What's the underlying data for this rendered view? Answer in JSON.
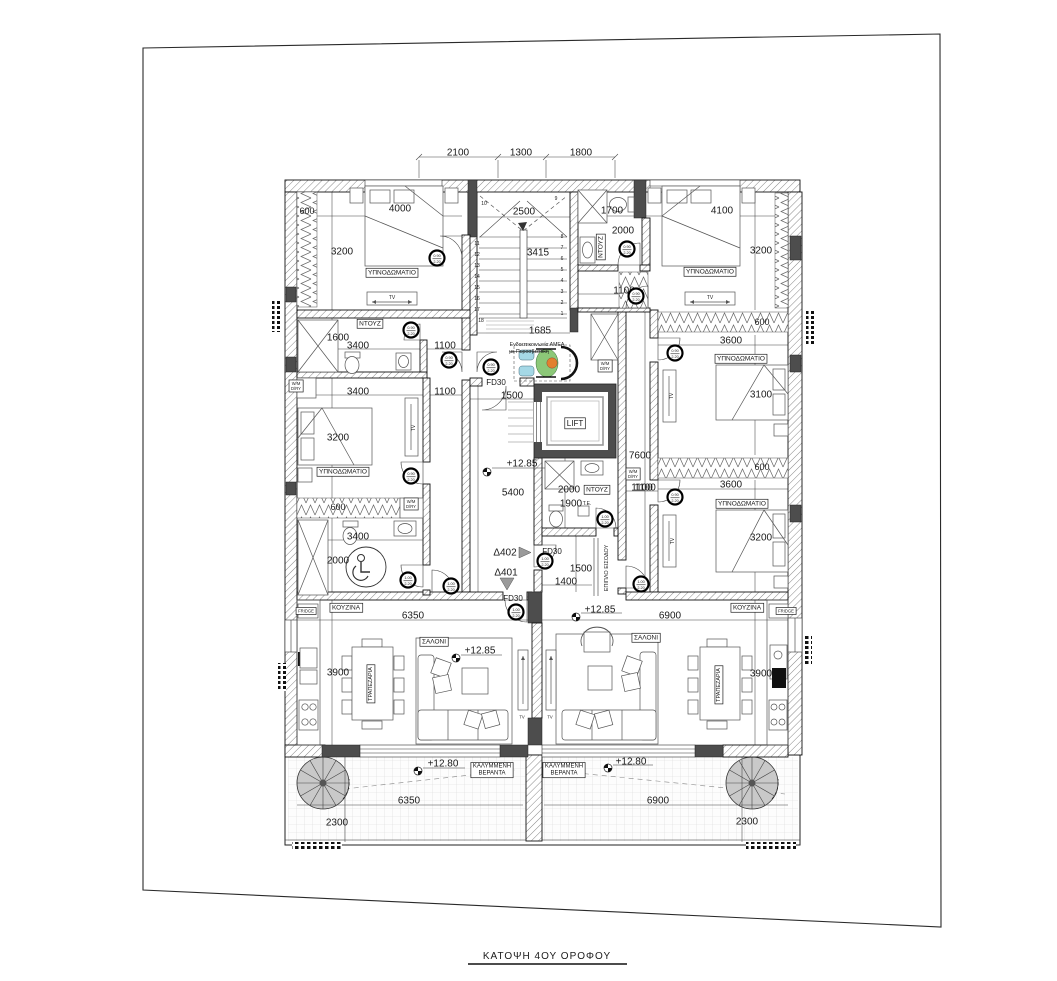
{
  "title": {
    "text": "ΚΑΤΟΨΗ 4ΟΥ ΟΡΟΦΟΥ"
  },
  "colors": {
    "wall_dark": "#4d4d4d",
    "wheelchair_blue": "#a5d8e6",
    "wheelchair_green": "#8cc878",
    "wheelchair_orange": "#e2802f",
    "spiral_gray": "#c9c9c9"
  },
  "plan": {
    "labels": [
      {
        "n": "dim-top-2100",
        "t": "2100",
        "x": 458,
        "y": 152,
        "s": 10
      },
      {
        "n": "dim-top-1300",
        "t": "1300",
        "x": 521,
        "y": 152,
        "s": 10
      },
      {
        "n": "dim-top-1800",
        "t": "1800",
        "x": 581,
        "y": 152,
        "s": 10
      },
      {
        "n": "dim-600-tl",
        "t": "600",
        "x": 307,
        "y": 211,
        "s": 9
      },
      {
        "n": "dim-4000",
        "t": "4000",
        "x": 400,
        "y": 208,
        "s": 10
      },
      {
        "n": "dim-3200-tl",
        "t": "3200",
        "x": 342,
        "y": 251,
        "s": 10
      },
      {
        "n": "room-bedroom-tl",
        "t": "ΥΠΝΟΔΩΜΑΤΙΟ",
        "x": 392,
        "y": 272,
        "s": 6.5,
        "b": 1
      },
      {
        "n": "tv-label-tl",
        "t": "TV",
        "x": 392,
        "y": 297,
        "s": 5
      },
      {
        "n": "dim-2500",
        "t": "2500",
        "x": 524,
        "y": 211,
        "s": 10
      },
      {
        "n": "dim-3415",
        "t": "3415",
        "x": 538,
        "y": 252,
        "s": 10
      },
      {
        "n": "dim-1685",
        "t": "1685",
        "x": 540,
        "y": 330,
        "s": 10
      },
      {
        "n": "step-8",
        "t": "8",
        "x": 562,
        "y": 236,
        "s": 5
      },
      {
        "n": "step-7",
        "t": "7",
        "x": 562,
        "y": 247,
        "s": 5
      },
      {
        "n": "step-6",
        "t": "6",
        "x": 562,
        "y": 258,
        "s": 5
      },
      {
        "n": "step-5",
        "t": "5",
        "x": 562,
        "y": 269,
        "s": 5
      },
      {
        "n": "step-4",
        "t": "4",
        "x": 562,
        "y": 280,
        "s": 5
      },
      {
        "n": "step-3",
        "t": "3",
        "x": 562,
        "y": 291,
        "s": 5
      },
      {
        "n": "step-2",
        "t": "2",
        "x": 562,
        "y": 302,
        "s": 5
      },
      {
        "n": "step-1",
        "t": "1",
        "x": 562,
        "y": 313,
        "s": 5
      },
      {
        "n": "step-11",
        "t": "11",
        "x": 477,
        "y": 243,
        "s": 5
      },
      {
        "n": "step-12",
        "t": "12",
        "x": 477,
        "y": 254,
        "s": 5
      },
      {
        "n": "step-13",
        "t": "13",
        "x": 477,
        "y": 265,
        "s": 5
      },
      {
        "n": "step-14",
        "t": "14",
        "x": 477,
        "y": 276,
        "s": 5
      },
      {
        "n": "step-15",
        "t": "15",
        "x": 477,
        "y": 287,
        "s": 5
      },
      {
        "n": "step-16",
        "t": "16",
        "x": 477,
        "y": 298,
        "s": 5
      },
      {
        "n": "step-17",
        "t": "17",
        "x": 477,
        "y": 309,
        "s": 5
      },
      {
        "n": "step-18",
        "t": "18",
        "x": 481,
        "y": 320,
        "s": 5
      },
      {
        "n": "step-9",
        "t": "9",
        "x": 556,
        "y": 198,
        "s": 5
      },
      {
        "n": "step-10",
        "t": "10",
        "x": 484,
        "y": 203,
        "s": 5
      },
      {
        "n": "amea-note",
        "t": "Ενδοεπικοινωνία ΑΜΕΑ",
        "x": 537,
        "y": 344,
        "s": 5.2
      },
      {
        "n": "amea-note-2",
        "t": "με Πυροσβεστική",
        "x": 529,
        "y": 351,
        "s": 5.2,
        "k": 1
      },
      {
        "n": "dim-1700",
        "t": "1700",
        "x": 612,
        "y": 210,
        "s": 10
      },
      {
        "n": "dim-2000-tr",
        "t": "2000",
        "x": 623,
        "y": 230,
        "s": 10
      },
      {
        "n": "room-ntouz-tr",
        "t": "ΝΤΟΥΖ",
        "x": 600,
        "y": 247,
        "s": 6.5,
        "r": -90,
        "b": 1
      },
      {
        "n": "dim-4100",
        "t": "4100",
        "x": 722,
        "y": 210,
        "s": 10
      },
      {
        "n": "dim-3200-tr",
        "t": "3200",
        "x": 761,
        "y": 250,
        "s": 10
      },
      {
        "n": "room-bedroom-tr",
        "t": "ΥΠΝΟΔΩΜΑΤΙΟ",
        "x": 710,
        "y": 271,
        "s": 6.5,
        "b": 1
      },
      {
        "n": "tv-label-tr",
        "t": "TV",
        "x": 710,
        "y": 297,
        "s": 5
      },
      {
        "n": "dim-1100-tr",
        "t": "1100",
        "x": 624,
        "y": 290,
        "s": 10
      },
      {
        "n": "wm-1",
        "L": [
          "W/M",
          "D/RY"
        ],
        "x": 605,
        "y": 366,
        "s": 4.2,
        "b": 1
      },
      {
        "n": "wm-2",
        "L": [
          "W/M",
          "D/RY"
        ],
        "x": 633,
        "y": 474,
        "s": 4.2,
        "b": 1
      },
      {
        "n": "wm-3",
        "L": [
          "W/M",
          "D/RY"
        ],
        "x": 411,
        "y": 504,
        "s": 4.2,
        "b": 1
      },
      {
        "n": "wm-4",
        "L": [
          "W/M",
          "D/RY"
        ],
        "x": 296,
        "y": 386,
        "s": 4.2,
        "b": 1
      },
      {
        "n": "dim-600-rm",
        "t": "600",
        "x": 762,
        "y": 322,
        "s": 9
      },
      {
        "n": "dim-3600-rm",
        "t": "3600",
        "x": 731,
        "y": 340,
        "s": 10
      },
      {
        "n": "room-bedroom-rm",
        "t": "ΥΠΝΟΔΩΜΑΤΙΟ",
        "x": 741,
        "y": 358,
        "s": 6.5,
        "b": 1
      },
      {
        "n": "dim-3100",
        "t": "3100",
        "x": 761,
        "y": 394,
        "s": 10
      },
      {
        "n": "tv-label-rm",
        "t": "TV",
        "x": 671,
        "y": 396,
        "s": 5,
        "r": -90
      },
      {
        "n": "dim-7600",
        "t": "7600",
        "x": 640,
        "y": 455,
        "s": 10
      },
      {
        "n": "dim-600-rm2",
        "t": "600",
        "x": 762,
        "y": 467,
        "s": 9
      },
      {
        "n": "dim-1100-rl",
        "t": "1100",
        "x": 642,
        "y": 487,
        "s": 10
      },
      {
        "n": "dim-3600-rl",
        "t": "3600",
        "x": 731,
        "y": 484,
        "s": 10
      },
      {
        "n": "room-bedroom-rl",
        "t": "ΥΠΝΟΔΩΜΑΤΙΟ",
        "x": 742,
        "y": 503,
        "s": 6.5,
        "b": 1
      },
      {
        "n": "dim-3200-rl",
        "t": "3200",
        "x": 761,
        "y": 537,
        "s": 10
      },
      {
        "n": "tv-label-rl",
        "t": "TV",
        "x": 672,
        "y": 541,
        "s": 5,
        "r": -90
      },
      {
        "n": "room-kitchen-r",
        "t": "ΚΟΥΖΙΝΑ",
        "x": 747,
        "y": 607,
        "s": 6.5,
        "b": 1
      },
      {
        "n": "fridge-r",
        "t": "FRIDGE",
        "x": 786,
        "y": 611,
        "s": 4.2,
        "b": 1
      },
      {
        "n": "dim-6900",
        "t": "6900",
        "x": 670,
        "y": 615,
        "s": 10
      },
      {
        "n": "room-ntouz-l",
        "t": "ΝΤΟΥΖ",
        "x": 370,
        "y": 323,
        "s": 6.5,
        "b": 1
      },
      {
        "n": "dim-1600",
        "t": "1600",
        "x": 338,
        "y": 337,
        "s": 10
      },
      {
        "n": "dim-3400-a",
        "t": "3400",
        "x": 358,
        "y": 345,
        "s": 10
      },
      {
        "n": "dim-1100-a",
        "t": "1100",
        "x": 445,
        "y": 345,
        "s": 10
      },
      {
        "n": "dim-3400-b",
        "t": "3400",
        "x": 358,
        "y": 391,
        "s": 10
      },
      {
        "n": "dim-1100-b",
        "t": "1100",
        "x": 445,
        "y": 391,
        "s": 10
      },
      {
        "n": "dim-3200-lm",
        "t": "3200",
        "x": 338,
        "y": 437,
        "s": 10
      },
      {
        "n": "room-bedroom-lm",
        "t": "ΥΠΝΟΔΩΜΑΤΙΟ",
        "x": 343,
        "y": 471,
        "s": 6.5,
        "b": 1
      },
      {
        "n": "tv-label-lm",
        "t": "TV",
        "x": 413,
        "y": 428,
        "s": 5,
        "r": -90
      },
      {
        "n": "dim-600-lm",
        "t": "600",
        "x": 338,
        "y": 507,
        "s": 9
      },
      {
        "n": "dim-3400-c",
        "t": "3400",
        "x": 358,
        "y": 536,
        "s": 10
      },
      {
        "n": "dim-2000-l",
        "t": "2000",
        "x": 338,
        "y": 560,
        "s": 10
      },
      {
        "n": "room-kitchen-l",
        "t": "ΚΟΥΖΙΝΑ",
        "x": 346,
        "y": 607,
        "s": 6.5,
        "b": 1
      },
      {
        "n": "fridge-l",
        "t": "FRIDGE",
        "x": 306,
        "y": 611,
        "s": 4.2,
        "b": 1
      },
      {
        "n": "dim-6350",
        "t": "6350",
        "x": 413,
        "y": 615,
        "s": 10
      },
      {
        "n": "fd30-a",
        "t": "FD30",
        "x": 496,
        "y": 382,
        "s": 8
      },
      {
        "n": "dim-1500-a",
        "t": "1500",
        "x": 512,
        "y": 395,
        "s": 10
      },
      {
        "n": "lift-label",
        "t": "LIFT",
        "x": 575,
        "y": 423,
        "s": 8,
        "b": 1
      },
      {
        "n": "level-corridor",
        "t": "+12.85",
        "x": 522,
        "y": 463,
        "s": 10
      },
      {
        "n": "dim-5400",
        "t": "5400",
        "x": 513,
        "y": 492,
        "s": 10
      },
      {
        "n": "dim-2000-c",
        "t": "2000",
        "x": 569,
        "y": 489,
        "s": 10
      },
      {
        "n": "room-ntouz-c",
        "t": "ΝΤΟΥΖ",
        "x": 597,
        "y": 489,
        "s": 6.5,
        "b": 1
      },
      {
        "n": "dim-1900",
        "t": "1900",
        "x": 571,
        "y": 503,
        "s": 10
      },
      {
        "n": "te-label",
        "t": "Τ.Ε.",
        "x": 587,
        "y": 503,
        "s": 5
      },
      {
        "n": "dim-1100-c",
        "t": "1100",
        "x": 645,
        "y": 487,
        "s": 10
      },
      {
        "n": "d402-label",
        "t": "Δ402",
        "x": 505,
        "y": 552,
        "s": 10
      },
      {
        "n": "d401-label",
        "t": "Δ401",
        "x": 506,
        "y": 572,
        "s": 10
      },
      {
        "n": "fd30-b",
        "t": "FD30",
        "x": 552,
        "y": 551,
        "s": 8
      },
      {
        "n": "dim-1500-b",
        "t": "1500",
        "x": 581,
        "y": 568,
        "s": 10
      },
      {
        "n": "dim-1400",
        "t": "1400",
        "x": 566,
        "y": 581,
        "s": 10
      },
      {
        "n": "epiplo-label",
        "t": "ΕΠΙΠΛΟ ΕΙΣΟΔΟΥ",
        "x": 606,
        "y": 568,
        "s": 5.5,
        "r": -90
      },
      {
        "n": "fd30-c",
        "t": "FD30",
        "x": 513,
        "y": 598,
        "s": 8
      },
      {
        "n": "level-right-living",
        "t": "+12.85",
        "x": 600,
        "y": 609,
        "s": 10
      },
      {
        "n": "room-saloni-l",
        "t": "ΣΑΛΟΝΙ",
        "x": 434,
        "y": 641,
        "s": 6.5,
        "b": 1
      },
      {
        "n": "level-left-living",
        "t": "+12.85",
        "x": 480,
        "y": 650,
        "s": 10
      },
      {
        "n": "dim-3900-l",
        "t": "3900",
        "x": 338,
        "y": 672,
        "s": 10
      },
      {
        "n": "room-dining-l",
        "t": "ΤΡΑΠΕΖΑΡΙΑ",
        "x": 370,
        "y": 684,
        "s": 5.5,
        "r": -90,
        "b": 1
      },
      {
        "n": "tv-label-wall-l",
        "t": "TV",
        "x": 522,
        "y": 717,
        "s": 4.2
      },
      {
        "n": "tv-label-wall-r",
        "t": "TV",
        "x": 550,
        "y": 717,
        "s": 4.2
      },
      {
        "n": "room-saloni-r",
        "t": "ΣΑΛΟΝΙ",
        "x": 646,
        "y": 637,
        "s": 6.5,
        "b": 1
      },
      {
        "n": "dim-3900-r",
        "t": "3900",
        "x": 761,
        "y": 673,
        "s": 10
      },
      {
        "n": "room-dining-r",
        "t": "ΤΡΑΠΕΖΑΡΙΑ",
        "x": 718,
        "y": 685,
        "s": 5.5,
        "r": -90,
        "b": 1
      },
      {
        "n": "level-veranda-l",
        "t": "+12.80",
        "x": 443,
        "y": 763,
        "s": 10
      },
      {
        "n": "room-veranda-l",
        "L": [
          "ΚΑΛΥΜΜΕΝΗ",
          "ΒΕΡΑΝΤΑ"
        ],
        "x": 492,
        "y": 769,
        "s": 6,
        "b": 1
      },
      {
        "n": "room-veranda-r",
        "L": [
          "ΚΑΛΥΜΜΕΝΗ",
          "ΒΕΡΑΝΤΑ"
        ],
        "x": 564,
        "y": 769,
        "s": 6,
        "b": 1
      },
      {
        "n": "level-veranda-r",
        "t": "+12.80",
        "x": 631,
        "y": 761,
        "s": 10
      },
      {
        "n": "dim-6350-v",
        "t": "6350",
        "x": 409,
        "y": 800,
        "s": 10
      },
      {
        "n": "dim-6900-v",
        "t": "6900",
        "x": 658,
        "y": 800,
        "s": 10
      },
      {
        "n": "dim-2300-l",
        "t": "2300",
        "x": 337,
        "y": 822,
        "s": 10
      },
      {
        "n": "dim-2300-r",
        "t": "2300",
        "x": 747,
        "y": 821,
        "s": 10
      }
    ],
    "badges": [
      {
        "n": "door-badge",
        "x": 411,
        "y": 330,
        "a": "0.90",
        "b": "2.20"
      },
      {
        "n": "door-badge",
        "x": 449,
        "y": 360,
        "a": "0.90",
        "b": "2.20"
      },
      {
        "n": "door-badge",
        "x": 491,
        "y": 367,
        "a": "0.90",
        "b": "2.20"
      },
      {
        "n": "door-badge",
        "x": 437,
        "y": 258,
        "a": "0.90",
        "b": "2.20"
      },
      {
        "n": "door-badge",
        "x": 411,
        "y": 476,
        "a": "0.90",
        "b": "2.20"
      },
      {
        "n": "door-badge",
        "x": 408,
        "y": 580,
        "a": "1.00",
        "b": "2.20"
      },
      {
        "n": "door-badge",
        "x": 451,
        "y": 586,
        "a": "1.00",
        "b": "2.20"
      },
      {
        "n": "door-badge",
        "x": 545,
        "y": 561,
        "a": "1.00",
        "b": "2.20"
      },
      {
        "n": "door-badge",
        "x": 516,
        "y": 612,
        "a": "1.00",
        "b": "2.20"
      },
      {
        "n": "door-badge",
        "x": 605,
        "y": 519,
        "a": "1.00",
        "b": "2.20"
      },
      {
        "n": "door-badge",
        "x": 641,
        "y": 584,
        "a": "1.00",
        "b": "2.20"
      },
      {
        "n": "door-badge",
        "x": 627,
        "y": 249,
        "a": "0.90",
        "b": "2.20"
      },
      {
        "n": "door-badge",
        "x": 636,
        "y": 296,
        "a": "0.90",
        "b": "2.20"
      },
      {
        "n": "door-badge",
        "x": 675,
        "y": 353,
        "a": "0.90",
        "b": "2.20"
      },
      {
        "n": "door-badge",
        "x": 675,
        "y": 497,
        "a": "0.90",
        "b": "2.20"
      }
    ]
  }
}
